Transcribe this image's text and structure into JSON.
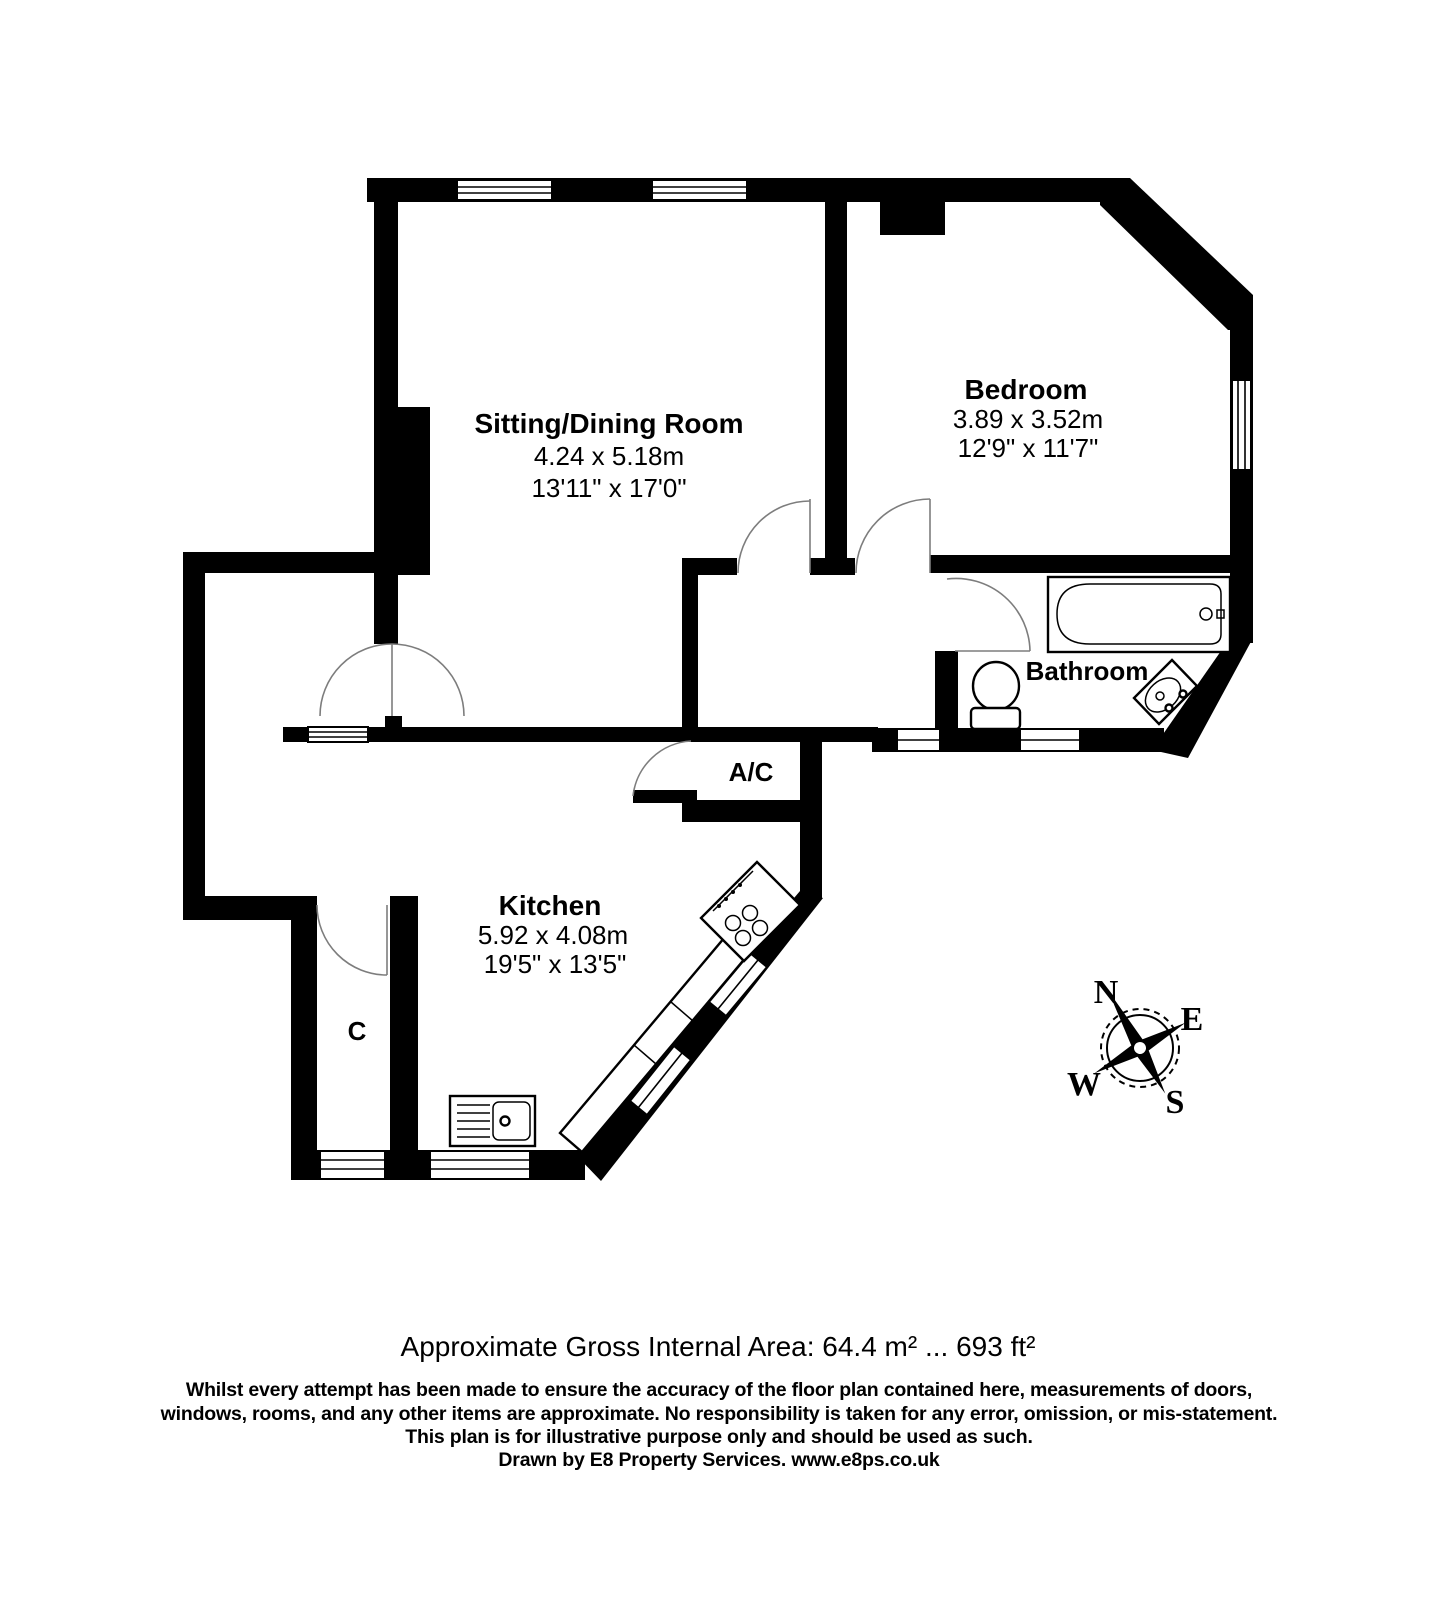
{
  "rooms": {
    "sitting": {
      "name": "Sitting/Dining Room",
      "metric": "4.24 x 5.18m",
      "imperial": "13'11\" x 17'0\""
    },
    "bedroom": {
      "name": "Bedroom",
      "metric": "3.89 x 3.52m",
      "imperial": "12'9\" x 11'7\""
    },
    "kitchen": {
      "name": "Kitchen",
      "metric": "5.92 x 4.08m",
      "imperial": "19'5\" x 13'5\""
    },
    "bathroom": {
      "name": "Bathroom"
    },
    "ac": {
      "name": "A/C"
    },
    "cupboard": {
      "name": "C"
    }
  },
  "compass": {
    "n": "N",
    "e": "E",
    "s": "S",
    "w": "W"
  },
  "footer": {
    "area": "Approximate Gross Internal Area: 64.4 m² ... 693 ft²",
    "disclaimer1": "Whilst every attempt has been made to ensure the accuracy of the floor plan contained here, measurements of doors,",
    "disclaimer2": "windows, rooms, and any other items are approximate. No responsibility is taken for any error, omission, or mis-statement.",
    "disclaimer3": "This plan is for illustrative purpose only and should be used as such.",
    "credit": "Drawn by E8 Property Services. www.e8ps.co.uk"
  },
  "colors": {
    "wall": "#000000",
    "background": "#ffffff",
    "door_arc": "#7d7d7d"
  }
}
